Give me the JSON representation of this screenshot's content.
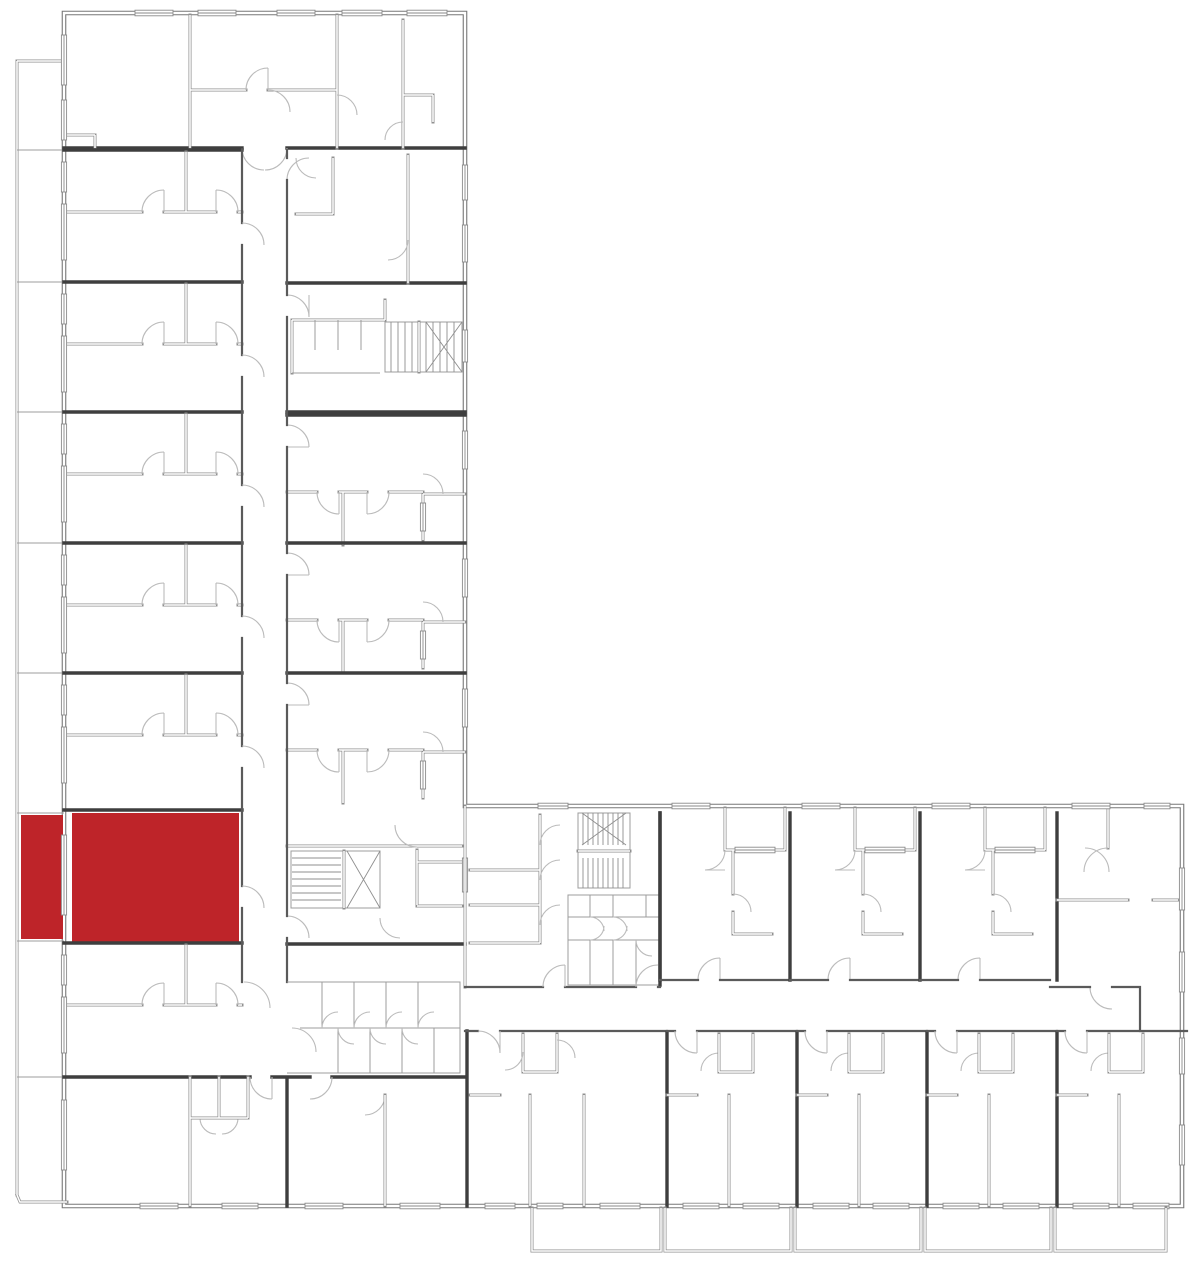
{
  "meta": {
    "title": "Building floor plan",
    "description": "L-shaped apartment building floor plan with one apartment unit and its west balcony highlighted in red"
  },
  "colors": {
    "background": "#ffffff",
    "exterior_wall": "#777777",
    "interior_wall": "#909090",
    "party_wall": "#3e3e3e",
    "door_arc": "#bbbbbb",
    "highlight": "#be2429"
  },
  "highlighted_unit": {
    "name": "highlighted-apartment",
    "room": {
      "x": 72,
      "y": 813,
      "width": 167,
      "height": 131
    },
    "balcony": {
      "x": 21,
      "y": 815,
      "width": 42,
      "height": 124
    }
  },
  "structure": {
    "wings": 2,
    "stairwells": 3,
    "corridors": 2,
    "bottom_balconies": 5
  }
}
